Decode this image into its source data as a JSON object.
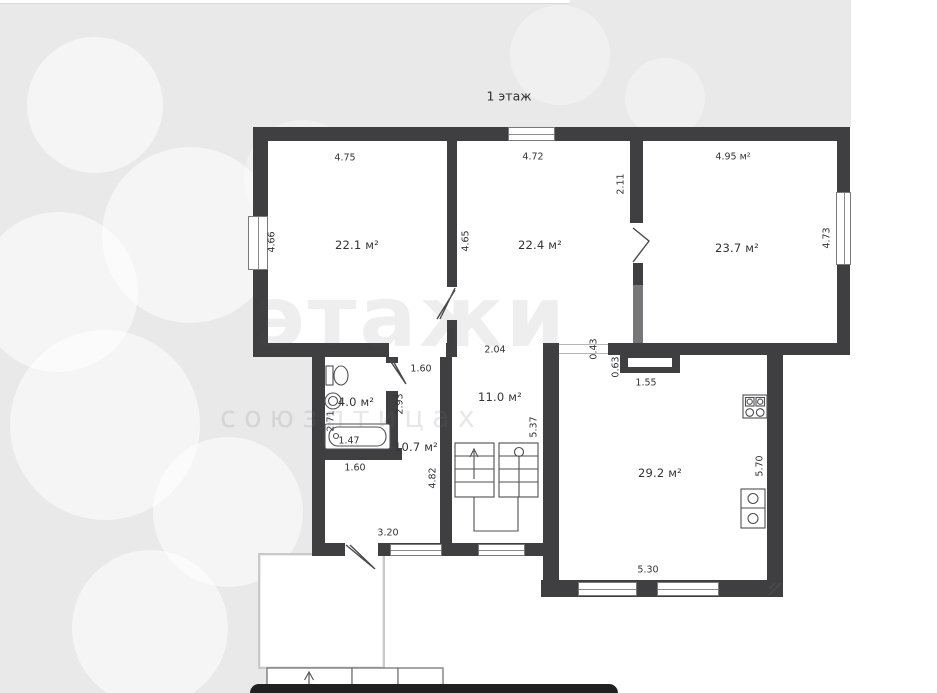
{
  "floor_plan": {
    "title": "1 этаж",
    "rooms": [
      {
        "name": "room-top-left",
        "area": "22.1 м²"
      },
      {
        "name": "room-top-middle",
        "area": "22.4 м²"
      },
      {
        "name": "room-top-right",
        "area": "23.7 м²"
      },
      {
        "name": "bathroom",
        "area": "4.0 м²"
      },
      {
        "name": "hallway",
        "area": "11.0 м²"
      },
      {
        "name": "corridor",
        "area": "10.7 м²"
      },
      {
        "name": "kitchen-living",
        "area": "29.2 м²"
      }
    ],
    "dimensions": {
      "top_room1": "4.75",
      "top_room2": "4.72",
      "top_room3": "4.95 м²",
      "left_room1": "4.66",
      "left_room2": "4.65",
      "divider_room3": "2.11",
      "right_room3": "4.73",
      "hall_width": "2.04",
      "upper_door": "1.60",
      "passage_stub": "0.43",
      "niche_depth": "0.63",
      "niche_width": "1.55",
      "corridor_height": "2.93",
      "bath_height": "2.71",
      "tub_length": "1.47",
      "hall_height": "5.37",
      "lower_door": "1.60",
      "stair_height": "4.82",
      "kitchen_height": "5.70",
      "bottom_width": "3.20",
      "kitchen_width": "5.30"
    },
    "watermark": {
      "logo": "этажи",
      "text": "союзптицах"
    },
    "colors": {
      "wall": "#3f3f41",
      "paper": "#ffffff",
      "canvas": "#e9e9ea",
      "bottom_bar": "#202020"
    }
  }
}
